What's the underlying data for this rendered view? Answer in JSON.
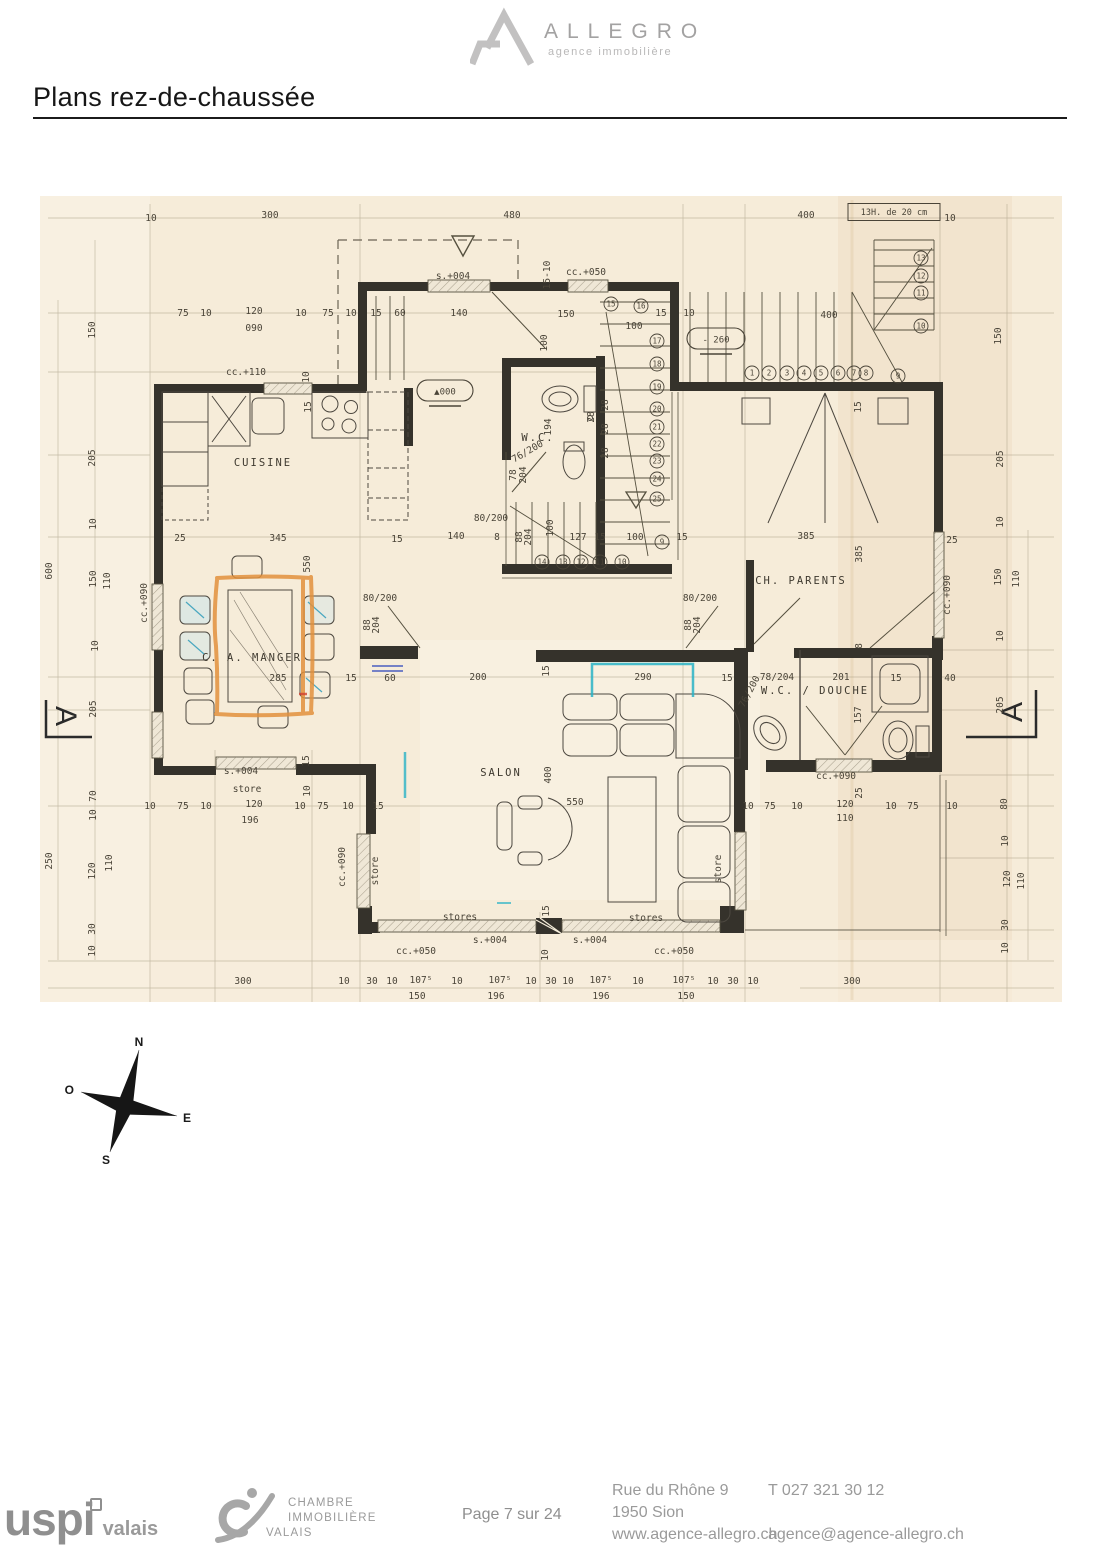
{
  "header": {
    "brand": "ALLEGRO",
    "tagline": "agence immobilière"
  },
  "title": "Plans rez-de-chaussée",
  "plan": {
    "section_marker": "A",
    "compass": {
      "n": "N",
      "e": "E",
      "s": "S",
      "o": "O"
    },
    "rooms": [
      {
        "label": "CUISINE",
        "x": 263,
        "y": 462
      },
      {
        "label": "C. A. MANGER",
        "x": 252,
        "y": 657
      },
      {
        "label": "SALON",
        "x": 501,
        "y": 772
      },
      {
        "label": "CH. PARENTS",
        "x": 801,
        "y": 580
      },
      {
        "label": "W.C. / DOUCHE",
        "x": 815,
        "y": 690
      },
      {
        "label": "W.C.",
        "x": 538,
        "y": 437
      }
    ],
    "ovals": [
      {
        "t": "▲000",
        "x": 445,
        "y": 391,
        "w": 56
      },
      {
        "t": "- 260",
        "x": 716,
        "y": 339,
        "w": 58
      }
    ],
    "boxes": [
      {
        "t": "13H. de 20 cm",
        "x": 894,
        "y": 212,
        "w": 92,
        "h": 17
      }
    ],
    "circled": [
      {
        "n": "1",
        "x": 752,
        "y": 373
      },
      {
        "n": "2",
        "x": 769,
        "y": 373
      },
      {
        "n": "3",
        "x": 787,
        "y": 373
      },
      {
        "n": "4",
        "x": 804,
        "y": 373
      },
      {
        "n": "5",
        "x": 821,
        "y": 373
      },
      {
        "n": "6",
        "x": 838,
        "y": 373
      },
      {
        "n": "7",
        "x": 854,
        "y": 373
      },
      {
        "n": "8",
        "x": 866,
        "y": 373
      },
      {
        "n": "9",
        "x": 898,
        "y": 376
      },
      {
        "n": "10",
        "x": 921,
        "y": 326
      },
      {
        "n": "11",
        "x": 921,
        "y": 293
      },
      {
        "n": "12",
        "x": 921,
        "y": 276
      },
      {
        "n": "13",
        "x": 921,
        "y": 258
      },
      {
        "n": "15",
        "x": 611,
        "y": 304
      },
      {
        "n": "16",
        "x": 641,
        "y": 306
      },
      {
        "n": "17",
        "x": 657,
        "y": 341
      },
      {
        "n": "18",
        "x": 657,
        "y": 364
      },
      {
        "n": "19",
        "x": 657,
        "y": 387
      },
      {
        "n": "20",
        "x": 657,
        "y": 409
      },
      {
        "n": "21",
        "x": 657,
        "y": 427
      },
      {
        "n": "22",
        "x": 657,
        "y": 444
      },
      {
        "n": "23",
        "x": 657,
        "y": 461
      },
      {
        "n": "24",
        "x": 657,
        "y": 479
      },
      {
        "n": "25",
        "x": 657,
        "y": 499
      },
      {
        "n": "9",
        "x": 662,
        "y": 542
      },
      {
        "n": "10",
        "x": 622,
        "y": 562
      },
      {
        "n": "11",
        "x": 600,
        "y": 562
      },
      {
        "n": "12",
        "x": 581,
        "y": 562
      },
      {
        "n": "13",
        "x": 563,
        "y": 562
      },
      {
        "n": "14",
        "x": 542,
        "y": 562
      }
    ],
    "dims": [
      {
        "t": "300",
        "x": 270,
        "y": 215
      },
      {
        "t": "480",
        "x": 512,
        "y": 215
      },
      {
        "t": "400",
        "x": 806,
        "y": 215
      },
      {
        "t": "10",
        "x": 151,
        "y": 218
      },
      {
        "t": "10",
        "x": 950,
        "y": 218
      },
      {
        "t": "75",
        "x": 183,
        "y": 313
      },
      {
        "t": "10",
        "x": 206,
        "y": 313
      },
      {
        "t": "120",
        "x": 254,
        "y": 311
      },
      {
        "t": "090",
        "x": 254,
        "y": 328
      },
      {
        "t": "10",
        "x": 301,
        "y": 313
      },
      {
        "t": "75",
        "x": 328,
        "y": 313
      },
      {
        "t": "10",
        "x": 351,
        "y": 313
      },
      {
        "t": "15",
        "x": 376,
        "y": 313
      },
      {
        "t": "60",
        "x": 400,
        "y": 313
      },
      {
        "t": "140",
        "x": 459,
        "y": 313
      },
      {
        "t": "150",
        "x": 566,
        "y": 314
      },
      {
        "t": "15",
        "x": 661,
        "y": 313
      },
      {
        "t": "10",
        "x": 689,
        "y": 313
      },
      {
        "t": "400",
        "x": 829,
        "y": 315
      },
      {
        "t": "15-10",
        "x": 550,
        "y": 272,
        "r": -90
      },
      {
        "t": "s.+004",
        "x": 453,
        "y": 276
      },
      {
        "t": "cc.+050",
        "x": 586,
        "y": 272
      },
      {
        "t": "100",
        "x": 547,
        "y": 340,
        "r": -90
      },
      {
        "t": "100",
        "x": 634,
        "y": 326
      },
      {
        "t": "cc.+110",
        "x": 246,
        "y": 372
      },
      {
        "t": "10",
        "x": 309,
        "y": 374,
        "r": -90
      },
      {
        "t": "15",
        "x": 311,
        "y": 404,
        "r": -90
      },
      {
        "t": "194",
        "x": 551,
        "y": 424,
        "r": -90
      },
      {
        "t": "76/200",
        "x": 529,
        "y": 451,
        "r": -30
      },
      {
        "t": "78",
        "x": 516,
        "y": 472,
        "r": -90
      },
      {
        "t": "204",
        "x": 526,
        "y": 472,
        "r": -90
      },
      {
        "t": "80/200",
        "x": 491,
        "y": 518
      },
      {
        "t": "140",
        "x": 456,
        "y": 536
      },
      {
        "t": "8",
        "x": 497,
        "y": 537
      },
      {
        "t": "88",
        "x": 522,
        "y": 534,
        "r": -90
      },
      {
        "t": "204",
        "x": 531,
        "y": 534,
        "r": -90
      },
      {
        "t": "100",
        "x": 553,
        "y": 525,
        "r": -90
      },
      {
        "t": "127",
        "x": 578,
        "y": 537
      },
      {
        "t": "15",
        "x": 600,
        "y": 537
      },
      {
        "t": "100",
        "x": 635,
        "y": 537
      },
      {
        "t": "15",
        "x": 682,
        "y": 537
      },
      {
        "t": "28",
        "x": 608,
        "y": 402,
        "r": -90
      },
      {
        "t": "28",
        "x": 608,
        "y": 426,
        "r": -90
      },
      {
        "t": "28",
        "x": 608,
        "y": 450,
        "r": -90
      },
      {
        "t": "28",
        "x": 594,
        "y": 414,
        "r": -90
      },
      {
        "t": "25",
        "x": 180,
        "y": 538
      },
      {
        "t": "345",
        "x": 278,
        "y": 538
      },
      {
        "t": "15",
        "x": 397,
        "y": 539
      },
      {
        "t": "550",
        "x": 310,
        "y": 561,
        "r": -90
      },
      {
        "t": "cc.+090",
        "x": 147,
        "y": 600,
        "r": -90
      },
      {
        "t": "80/200",
        "x": 380,
        "y": 598
      },
      {
        "t": "88",
        "x": 370,
        "y": 622,
        "r": -90
      },
      {
        "t": "204",
        "x": 379,
        "y": 622,
        "r": -90
      },
      {
        "t": "80/200",
        "x": 700,
        "y": 598
      },
      {
        "t": "88",
        "x": 691,
        "y": 622,
        "r": -90
      },
      {
        "t": "204",
        "x": 700,
        "y": 622,
        "r": -90
      },
      {
        "t": "385",
        "x": 806,
        "y": 536
      },
      {
        "t": "385",
        "x": 862,
        "y": 551,
        "r": -90
      },
      {
        "t": "25",
        "x": 952,
        "y": 540
      },
      {
        "t": "15",
        "x": 861,
        "y": 404,
        "r": -90
      },
      {
        "t": "cc.+090",
        "x": 950,
        "y": 592,
        "r": -90
      },
      {
        "t": "8",
        "x": 862,
        "y": 643,
        "r": -90
      },
      {
        "t": "15",
        "x": 351,
        "y": 678
      },
      {
        "t": "60",
        "x": 390,
        "y": 678
      },
      {
        "t": "200",
        "x": 478,
        "y": 677
      },
      {
        "t": "290",
        "x": 643,
        "y": 677
      },
      {
        "t": "15",
        "x": 727,
        "y": 678
      },
      {
        "t": "78/204",
        "x": 777,
        "y": 677
      },
      {
        "t": "201",
        "x": 841,
        "y": 677
      },
      {
        "t": "15",
        "x": 896,
        "y": 678
      },
      {
        "t": "40",
        "x": 950,
        "y": 678
      },
      {
        "t": "76/200",
        "x": 752,
        "y": 690,
        "r": -62
      },
      {
        "t": "157",
        "x": 861,
        "y": 712,
        "r": -90
      },
      {
        "t": "285",
        "x": 278,
        "y": 678
      },
      {
        "t": "15",
        "x": 549,
        "y": 668,
        "r": -90
      },
      {
        "t": "400",
        "x": 551,
        "y": 772,
        "r": -90
      },
      {
        "t": "550",
        "x": 575,
        "y": 802
      },
      {
        "t": "s.+004",
        "x": 241,
        "y": 771
      },
      {
        "t": "store",
        "x": 247,
        "y": 789
      },
      {
        "t": "15",
        "x": 309,
        "y": 758,
        "r": -90
      },
      {
        "t": "10",
        "x": 310,
        "y": 788,
        "r": -90
      },
      {
        "t": "10",
        "x": 150,
        "y": 806
      },
      {
        "t": "75",
        "x": 183,
        "y": 806
      },
      {
        "t": "10",
        "x": 206,
        "y": 806
      },
      {
        "t": "120",
        "x": 254,
        "y": 804
      },
      {
        "t": "196",
        "x": 250,
        "y": 820
      },
      {
        "t": "10",
        "x": 300,
        "y": 806
      },
      {
        "t": "75",
        "x": 323,
        "y": 806
      },
      {
        "t": "10",
        "x": 348,
        "y": 806
      },
      {
        "t": "15",
        "x": 378,
        "y": 806
      },
      {
        "t": "cc.+090",
        "x": 345,
        "y": 864,
        "r": -90
      },
      {
        "t": "store",
        "x": 378,
        "y": 868,
        "r": -90
      },
      {
        "t": "10",
        "x": 748,
        "y": 806
      },
      {
        "t": "75",
        "x": 770,
        "y": 806
      },
      {
        "t": "10",
        "x": 797,
        "y": 806
      },
      {
        "t": "120",
        "x": 845,
        "y": 804
      },
      {
        "t": "110",
        "x": 845,
        "y": 818
      },
      {
        "t": "10",
        "x": 891,
        "y": 806
      },
      {
        "t": "75",
        "x": 913,
        "y": 806
      },
      {
        "t": "10",
        "x": 952,
        "y": 806
      },
      {
        "t": "25",
        "x": 862,
        "y": 790,
        "r": -90
      },
      {
        "t": "cc.+090",
        "x": 836,
        "y": 776
      },
      {
        "t": "store",
        "x": 721,
        "y": 866,
        "r": -90
      },
      {
        "t": "stores",
        "x": 460,
        "y": 917
      },
      {
        "t": "stores",
        "x": 646,
        "y": 918
      },
      {
        "t": "15",
        "x": 549,
        "y": 908,
        "r": -90
      },
      {
        "t": "s.+004",
        "x": 490,
        "y": 940
      },
      {
        "t": "s.+004",
        "x": 590,
        "y": 940
      },
      {
        "t": "cc.+050",
        "x": 416,
        "y": 951
      },
      {
        "t": "cc.+050",
        "x": 674,
        "y": 951
      },
      {
        "t": "10",
        "x": 548,
        "y": 952,
        "r": -90
      },
      {
        "t": "300",
        "x": 243,
        "y": 981
      },
      {
        "t": "300",
        "x": 852,
        "y": 981
      },
      {
        "t": "10",
        "x": 344,
        "y": 981
      },
      {
        "t": "30",
        "x": 372,
        "y": 981
      },
      {
        "t": "10",
        "x": 392,
        "y": 981
      },
      {
        "t": "107⁵",
        "x": 421,
        "y": 980
      },
      {
        "t": "10",
        "x": 457,
        "y": 981
      },
      {
        "t": "107⁵",
        "x": 500,
        "y": 980
      },
      {
        "t": "10",
        "x": 531,
        "y": 981
      },
      {
        "t": "30",
        "x": 551,
        "y": 981
      },
      {
        "t": "10",
        "x": 568,
        "y": 981
      },
      {
        "t": "107⁵",
        "x": 601,
        "y": 980
      },
      {
        "t": "10",
        "x": 638,
        "y": 981
      },
      {
        "t": "107⁵",
        "x": 684,
        "y": 980
      },
      {
        "t": "10",
        "x": 713,
        "y": 981
      },
      {
        "t": "30",
        "x": 733,
        "y": 981
      },
      {
        "t": "10",
        "x": 753,
        "y": 981
      },
      {
        "t": "150",
        "x": 417,
        "y": 996
      },
      {
        "t": "196",
        "x": 496,
        "y": 996
      },
      {
        "t": "196",
        "x": 601,
        "y": 996
      },
      {
        "t": "150",
        "x": 686,
        "y": 996
      },
      {
        "t": "150",
        "x": 95,
        "y": 327,
        "r": -90
      },
      {
        "t": "205",
        "x": 95,
        "y": 455,
        "r": -90
      },
      {
        "t": "10",
        "x": 96,
        "y": 521,
        "r": -90
      },
      {
        "t": "600",
        "x": 52,
        "y": 568,
        "r": -90
      },
      {
        "t": "150",
        "x": 96,
        "y": 576,
        "r": -90
      },
      {
        "t": "110",
        "x": 110,
        "y": 578,
        "r": -90
      },
      {
        "t": "10",
        "x": 98,
        "y": 643,
        "r": -90
      },
      {
        "t": "205",
        "x": 96,
        "y": 706,
        "r": -90
      },
      {
        "t": "70",
        "x": 96,
        "y": 793,
        "r": -90
      },
      {
        "t": "10",
        "x": 96,
        "y": 812,
        "r": -90
      },
      {
        "t": "250",
        "x": 52,
        "y": 858,
        "r": -90
      },
      {
        "t": "120",
        "x": 95,
        "y": 868,
        "r": -90
      },
      {
        "t": "110",
        "x": 112,
        "y": 860,
        "r": -90
      },
      {
        "t": "30",
        "x": 95,
        "y": 926,
        "r": -90
      },
      {
        "t": "10",
        "x": 95,
        "y": 948,
        "r": -90
      },
      {
        "t": "150",
        "x": 1001,
        "y": 333,
        "r": -90
      },
      {
        "t": "205",
        "x": 1003,
        "y": 456,
        "r": -90
      },
      {
        "t": "10",
        "x": 1003,
        "y": 519,
        "r": -90
      },
      {
        "t": "150",
        "x": 1001,
        "y": 574,
        "r": -90
      },
      {
        "t": "110",
        "x": 1019,
        "y": 576,
        "r": -90
      },
      {
        "t": "10",
        "x": 1003,
        "y": 633,
        "r": -90
      },
      {
        "t": "205",
        "x": 1003,
        "y": 702,
        "r": -90
      },
      {
        "t": "80",
        "x": 1007,
        "y": 801,
        "r": -90
      },
      {
        "t": "10",
        "x": 1008,
        "y": 838,
        "r": -90
      },
      {
        "t": "120",
        "x": 1010,
        "y": 876,
        "r": -90
      },
      {
        "t": "110",
        "x": 1024,
        "y": 878,
        "r": -90
      },
      {
        "t": "30",
        "x": 1008,
        "y": 922,
        "r": -90
      },
      {
        "t": "10",
        "x": 1008,
        "y": 945,
        "r": -90
      }
    ]
  },
  "footer": {
    "page_label": "Page 7 sur 24",
    "uspi": {
      "main": "uspi",
      "region": "valais"
    },
    "civ_lines": [
      "CHAMBRE",
      "IMMOBILIÈRE",
      "VALAIS"
    ],
    "address_lines": [
      "Rue du Rhône 9",
      "1950 Sion",
      "www.agence-allegro.ch"
    ],
    "contact_phone": "T 027 321 30 12",
    "contact_email": "agence@agence-allegro.ch"
  }
}
